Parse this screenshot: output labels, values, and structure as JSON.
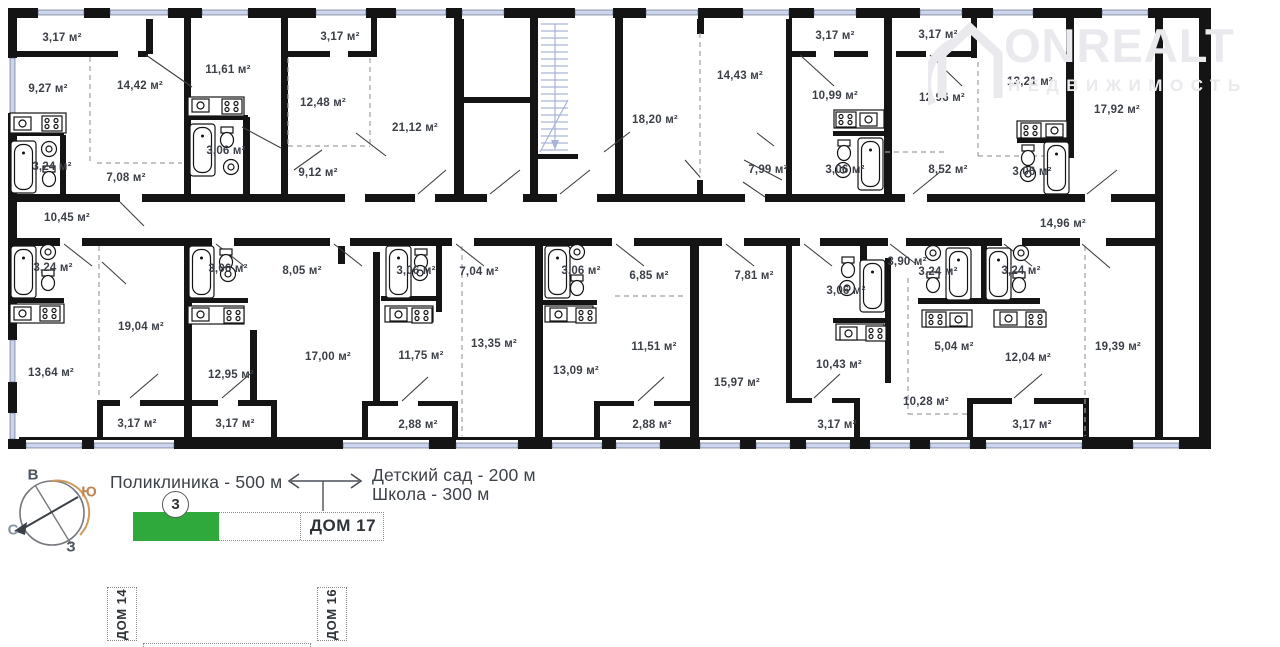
{
  "watermark": {
    "brand": "ONREALT",
    "subtitle": "НЕДВИЖИМОСТЬ"
  },
  "plan": {
    "rooms": [
      {
        "t": "3,17 м²",
        "x": 62,
        "y": 38
      },
      {
        "t": "9,27 м²",
        "x": 48,
        "y": 89
      },
      {
        "t": "14,42 м²",
        "x": 140,
        "y": 86
      },
      {
        "t": "11,61 м²",
        "x": 228,
        "y": 70
      },
      {
        "t": "3,17 м²",
        "x": 340,
        "y": 37
      },
      {
        "t": "12,48 м²",
        "x": 323,
        "y": 103
      },
      {
        "t": "3,06 м²",
        "x": 226,
        "y": 151
      },
      {
        "t": "3,24 м²",
        "x": 52,
        "y": 167
      },
      {
        "t": "7,08 м²",
        "x": 126,
        "y": 178
      },
      {
        "t": "9,12 м²",
        "x": 318,
        "y": 173
      },
      {
        "t": "21,12 м²",
        "x": 415,
        "y": 128
      },
      {
        "t": "18,20 м²",
        "x": 655,
        "y": 120
      },
      {
        "t": "14,43 м²",
        "x": 740,
        "y": 76
      },
      {
        "t": "3,17 м²",
        "x": 835,
        "y": 36
      },
      {
        "t": "10,99 м²",
        "x": 835,
        "y": 96
      },
      {
        "t": "7,99 м²",
        "x": 768,
        "y": 170
      },
      {
        "t": "3,06 м²",
        "x": 845,
        "y": 170
      },
      {
        "t": "3,17 м²",
        "x": 938,
        "y": 35
      },
      {
        "t": "12,96 м²",
        "x": 942,
        "y": 98
      },
      {
        "t": "13,21 м²",
        "x": 1030,
        "y": 82
      },
      {
        "t": "17,92 м²",
        "x": 1117,
        "y": 110
      },
      {
        "t": "8,52 м²",
        "x": 948,
        "y": 170
      },
      {
        "t": "3,06 м²",
        "x": 1032,
        "y": 172
      },
      {
        "t": "10,45 м²",
        "x": 67,
        "y": 218
      },
      {
        "t": "14,96 м²",
        "x": 1063,
        "y": 224
      },
      {
        "t": "3,24 м²",
        "x": 53,
        "y": 268
      },
      {
        "t": "3,06 м²",
        "x": 228,
        "y": 269
      },
      {
        "t": "8,05 м²",
        "x": 302,
        "y": 271
      },
      {
        "t": "3,06 м²",
        "x": 416,
        "y": 271
      },
      {
        "t": "7,04 м²",
        "x": 479,
        "y": 272
      },
      {
        "t": "3,06 м²",
        "x": 581,
        "y": 271
      },
      {
        "t": "6,85 м²",
        "x": 649,
        "y": 276
      },
      {
        "t": "7,81 м²",
        "x": 754,
        "y": 276
      },
      {
        "t": "3,90 м²",
        "x": 907,
        "y": 262
      },
      {
        "t": "3,06 м²",
        "x": 846,
        "y": 291
      },
      {
        "t": "3,24 м²",
        "x": 938,
        "y": 272
      },
      {
        "t": "3,24 м²",
        "x": 1021,
        "y": 271
      },
      {
        "t": "19,04 м²",
        "x": 141,
        "y": 327
      },
      {
        "t": "13,64 м²",
        "x": 51,
        "y": 373
      },
      {
        "t": "12,95 м²",
        "x": 231,
        "y": 375
      },
      {
        "t": "17,00 м²",
        "x": 328,
        "y": 357
      },
      {
        "t": "11,75 м²",
        "x": 421,
        "y": 356
      },
      {
        "t": "13,35 м²",
        "x": 494,
        "y": 344
      },
      {
        "t": "13,09 м²",
        "x": 576,
        "y": 371
      },
      {
        "t": "11,51 м²",
        "x": 654,
        "y": 347
      },
      {
        "t": "15,97 м²",
        "x": 737,
        "y": 383
      },
      {
        "t": "10,43 м²",
        "x": 839,
        "y": 365
      },
      {
        "t": "5,04 м²",
        "x": 954,
        "y": 347
      },
      {
        "t": "12,04 м²",
        "x": 1028,
        "y": 358
      },
      {
        "t": "19,39 м²",
        "x": 1118,
        "y": 347
      },
      {
        "t": "10,28 м²",
        "x": 926,
        "y": 402
      },
      {
        "t": "3,17 м²",
        "x": 137,
        "y": 424
      },
      {
        "t": "3,17 м²",
        "x": 235,
        "y": 424
      },
      {
        "t": "2,88 м²",
        "x": 418,
        "y": 425
      },
      {
        "t": "2,88 м²",
        "x": 652,
        "y": 425
      },
      {
        "t": "3,17 м²",
        "x": 837,
        "y": 425
      },
      {
        "t": "3,17 м²",
        "x": 1032,
        "y": 425
      }
    ]
  },
  "compass": {
    "east": "В",
    "south": "Ю",
    "north": "С",
    "west": "З"
  },
  "legend": {
    "clinic": "Поликлиника - 500 м",
    "kindergarten": "Детский сад - 200 м",
    "school": "Школа - 300 м",
    "floor_badge": "3",
    "house_current": "ДОМ 17",
    "house_left": "ДОМ 14",
    "house_right": "ДОМ 16"
  },
  "colors": {
    "accent_green": "#2fa93c",
    "wall": "#141414",
    "window": "#ccd5ec",
    "compass_south": "#c08552",
    "compass_north": "#8795a8",
    "compass_ew": "#4d545c"
  }
}
